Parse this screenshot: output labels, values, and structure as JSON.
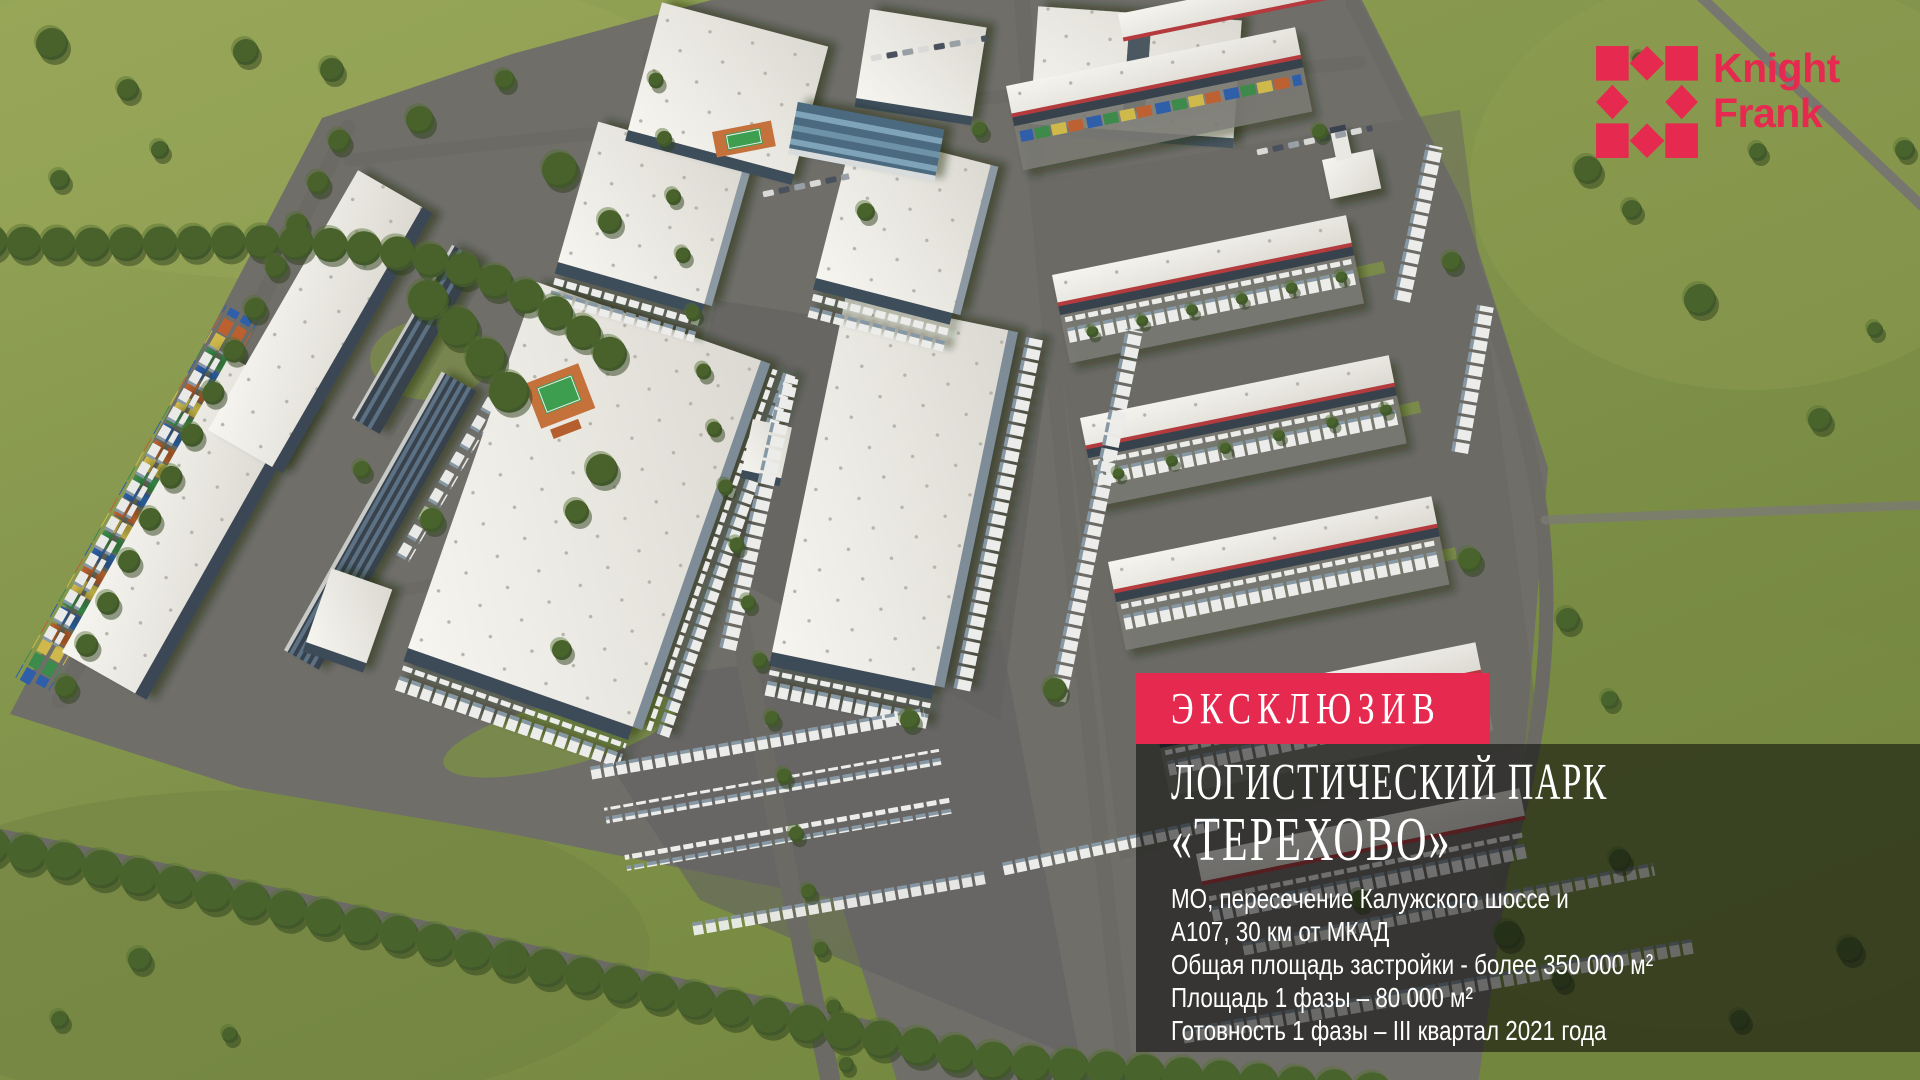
{
  "colors": {
    "brand": "#E6294F",
    "panel_overlay": "rgba(8,8,8,0.55)",
    "banner_background": "#E6294F",
    "grass": "#82934A",
    "asphalt": "#6F6E69",
    "roof_white": "#F1F0EA"
  },
  "logo": {
    "line1": "Knight",
    "line2": "Frank"
  },
  "banner": {
    "label": "ЭКСКЛЮЗИВ"
  },
  "panel": {
    "title_line1": "ЛОГИСТИЧЕСКИЙ ПАРК",
    "title_line2": "«ТЕРЕХОВО»",
    "details": [
      "МО, пересечение Калужского шоссе и",
      "А107, 30 км от МКАД",
      "Общая площадь застройки - более 350 000 м²",
      "Площадь 1 фазы – 80 000 м²",
      "Готовность 1 фазы – III квартал 2021 года"
    ]
  },
  "scene": {
    "type": "aerial-3d-render",
    "description": "Bird's-eye render of a logistics park: white warehouse blocks with dock trucks, container yard on the left, red-trimmed cross-dock buildings on the right, tree-lined roads and green fields"
  }
}
